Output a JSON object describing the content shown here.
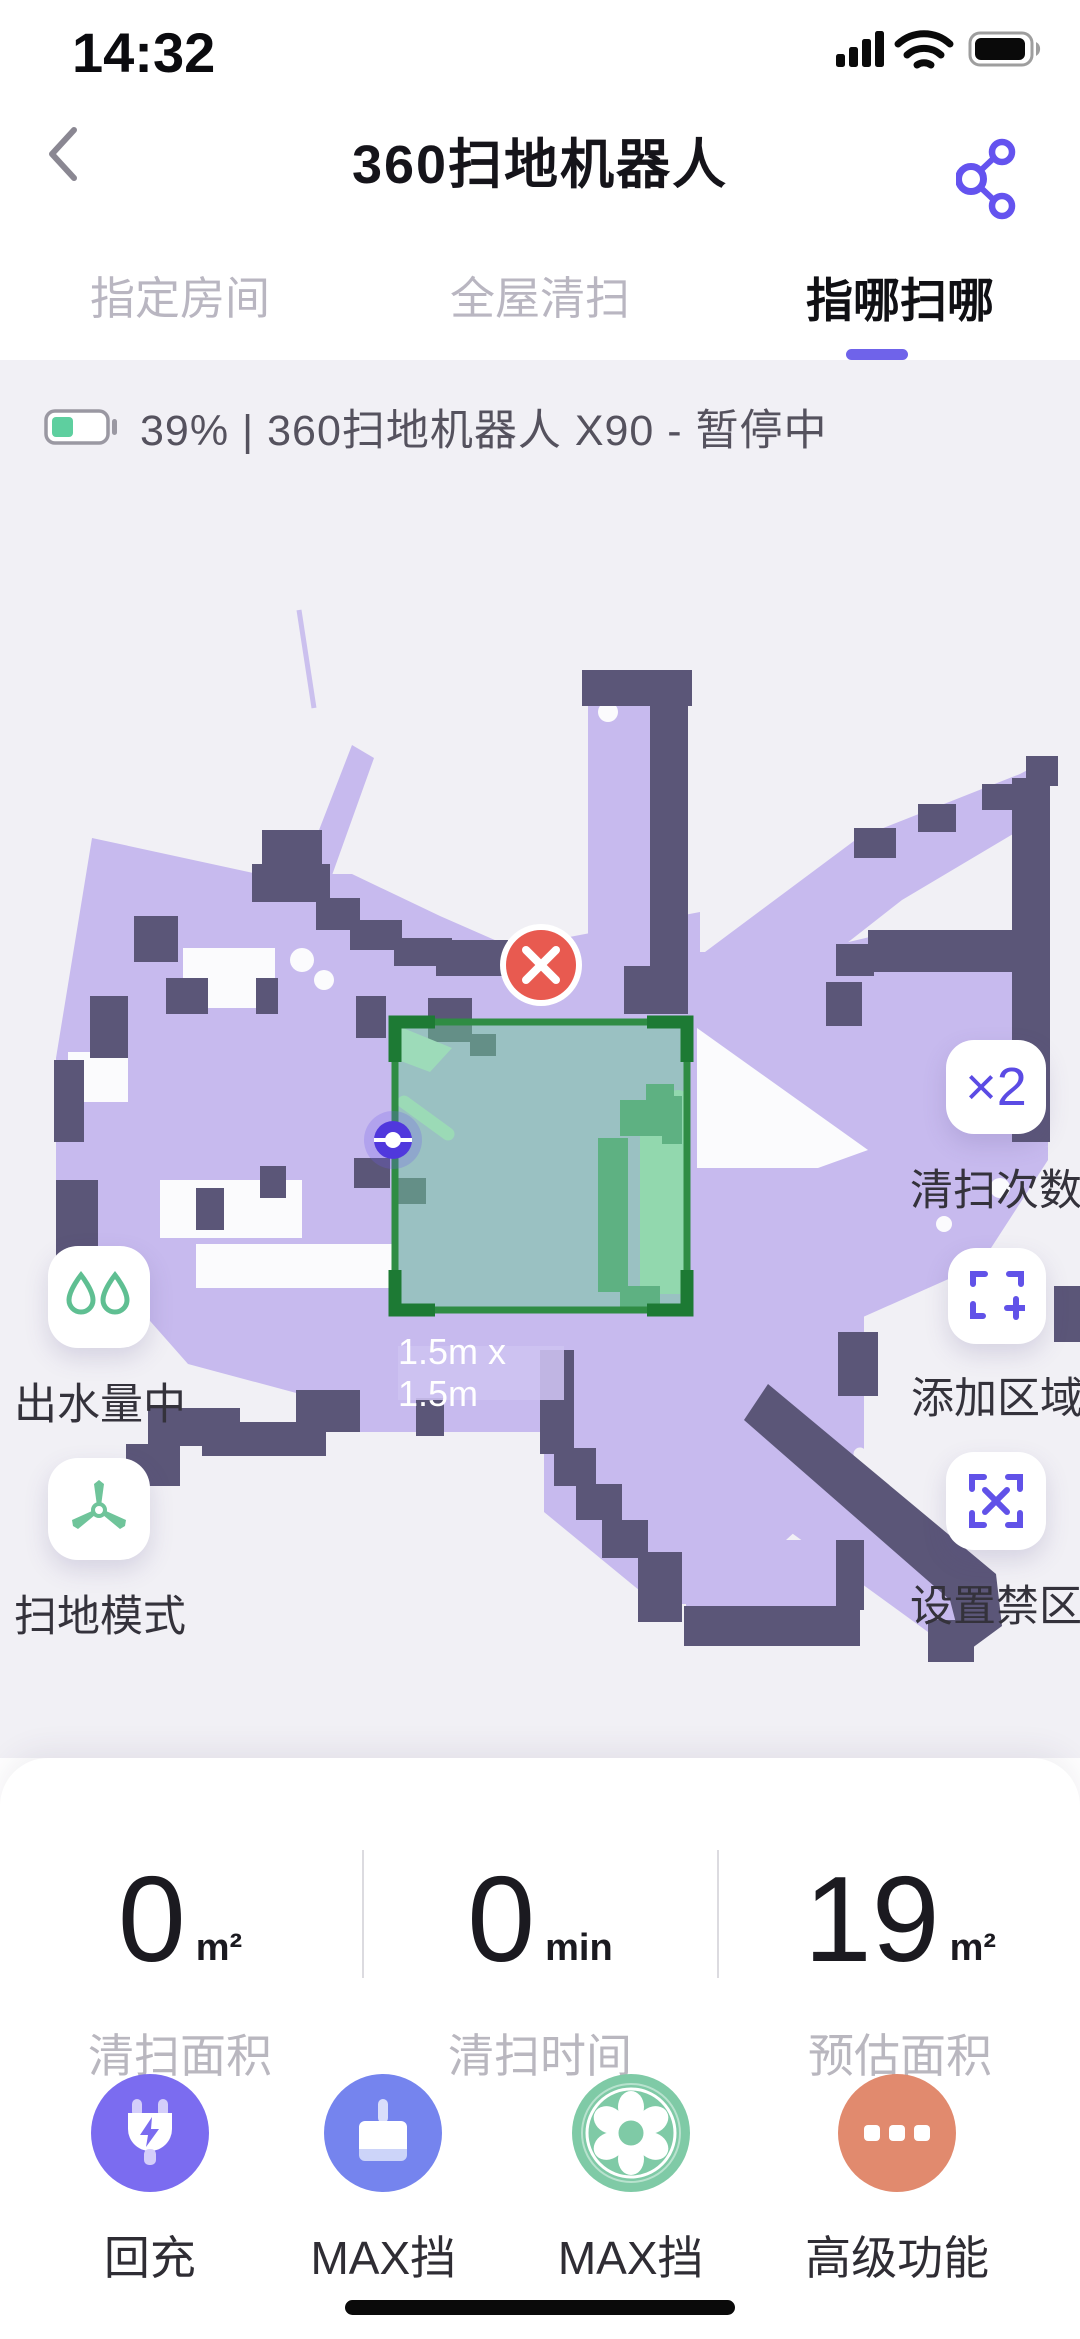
{
  "status_bar": {
    "time": "14:32"
  },
  "header": {
    "title": "360扫地机器人"
  },
  "tabs": [
    {
      "label": "指定房间",
      "active": false
    },
    {
      "label": "全屋清扫",
      "active": false
    },
    {
      "label": "指哪扫哪",
      "active": true
    }
  ],
  "device_status": {
    "text": "39%  |  360扫地机器人 X90 - 暂停中",
    "battery_percent": 39
  },
  "map": {
    "zone_label": "1.5m x 1.5m",
    "left_controls": [
      {
        "id": "water-level",
        "label": "出水量中"
      },
      {
        "id": "sweep-mode",
        "label": "扫地模式"
      }
    ],
    "right_controls": [
      {
        "id": "clean-times",
        "label": "清扫次数",
        "badge": "×2"
      },
      {
        "id": "add-zone",
        "label": "添加区域"
      },
      {
        "id": "no-go-zone",
        "label": "设置禁区"
      }
    ]
  },
  "stats": [
    {
      "value": "0",
      "unit": "m²",
      "label": "清扫面积"
    },
    {
      "value": "0",
      "unit": "min",
      "label": "清扫时间"
    },
    {
      "value": "19",
      "unit": "m²",
      "label": "预估面积"
    }
  ],
  "actions": [
    {
      "id": "recharge",
      "label": "回充",
      "icon": "plug-icon",
      "color": "#7b6cf0"
    },
    {
      "id": "go-clean",
      "label": "去清扫",
      "icon": "broom-icon",
      "color": "#7584ee"
    },
    {
      "id": "max-gear",
      "label": "MAX挡",
      "icon": "fan-icon",
      "color": "#7fcaa6"
    },
    {
      "id": "advanced",
      "label": "高级功能",
      "icon": "ellipsis-icon",
      "color": "#e18a6e"
    }
  ],
  "colors": {
    "accent_purple": "#6f63ea",
    "map_floor": "#c7baee",
    "map_wall": "#5b5678",
    "zone_green_border": "#2f8c44",
    "stop_red": "#e85a50",
    "battery_green": "#5ecf9f"
  }
}
